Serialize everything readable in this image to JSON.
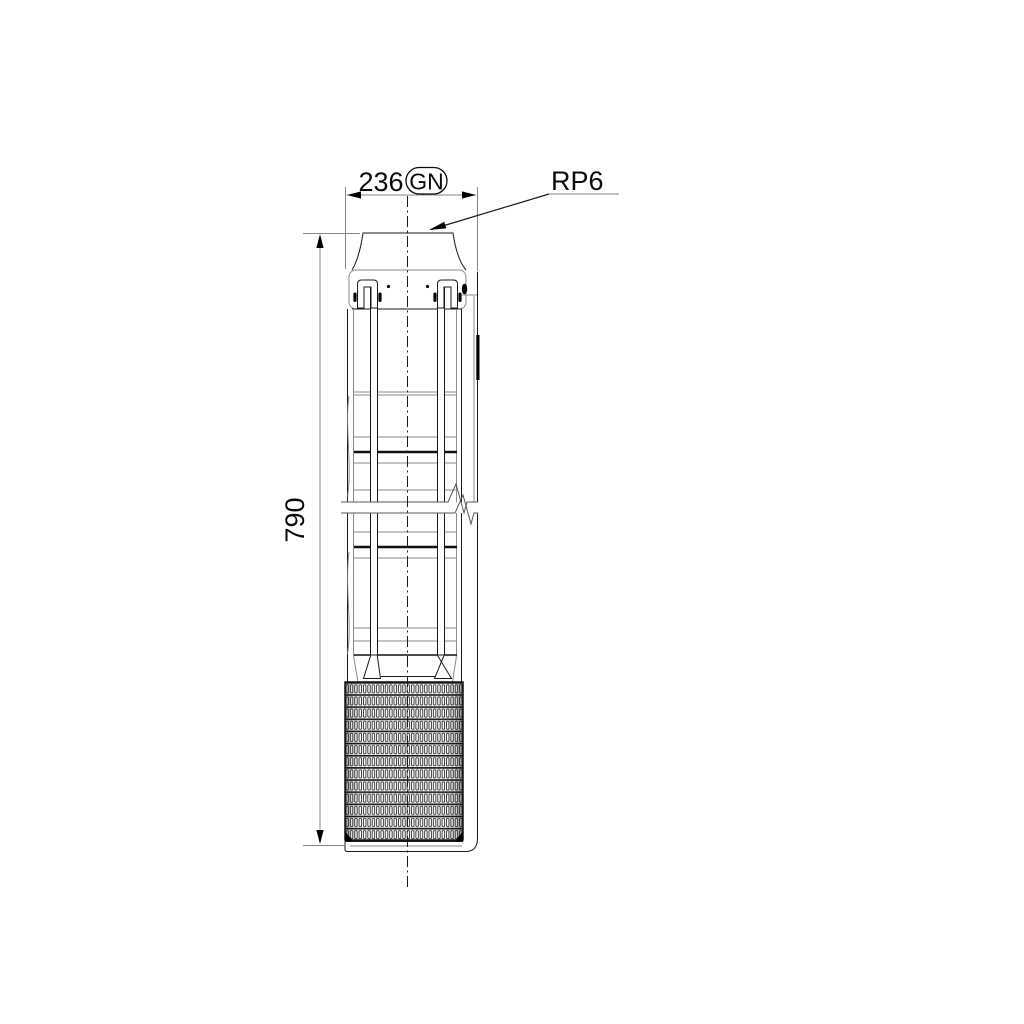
{
  "drawing": {
    "connection_label": "RP6",
    "dimensions": {
      "width": {
        "value": "236",
        "badge": "GN"
      },
      "height": {
        "value": "790"
      }
    },
    "colors": {
      "background": "#ffffff",
      "outline": "#1a1a1a",
      "dim_line": "#858585",
      "text": "#0a0a0a"
    }
  }
}
